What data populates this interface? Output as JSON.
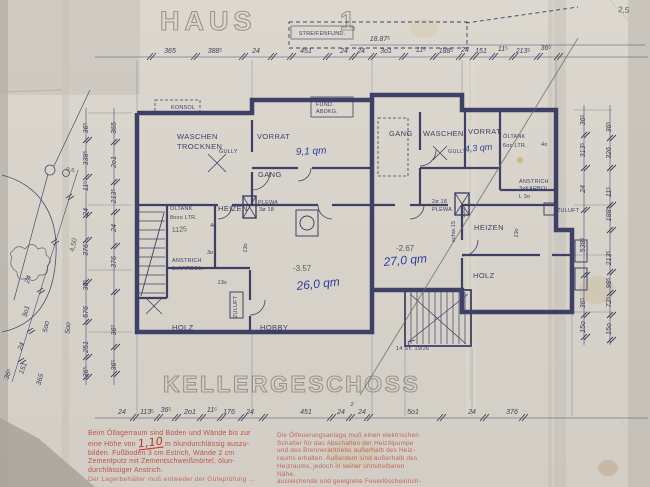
{
  "titles": {
    "haus": "HAUS",
    "house_no": "1",
    "floor": "KELLERGESCHOSS"
  },
  "annotations": {
    "streifenfund": "STREIFENFUND.",
    "overall": "18.87⁵",
    "corner": "2,5",
    "konsol": "KONSOL",
    "fund1": "FUND.",
    "fund2": "ABDKG.",
    "tree_h": "0,6",
    "pencil_len": "4,50",
    "pencil_tank": "1125",
    "stairs": "14 ST. 19/26",
    "schw": "schw.15"
  },
  "rooms": {
    "waschen1": "WASCHEN",
    "waschen2": "TROCKNEN",
    "vorrat_l": "VORRAT",
    "area_vorrat_l": "9,1 qm",
    "gang_l": "GANG",
    "gully_l": "GULLY",
    "oeltank_l1": "ÖLTANK",
    "oeltank_l2": "8ooo LTR.",
    "heizen_l": "HEIZEN",
    "plewa_l1": "PLEWA",
    "plewa_l2": "3ø 18",
    "anstrich1": "ANSTRICH",
    "anstrich2": "3xKARBOL.",
    "holz_l": "HOLZ",
    "hobby": "HOBBY",
    "zuluft": "ZULUFT",
    "level_l": "-3.57",
    "area_hobby": "26,0 qm",
    "gang_r": "GANG",
    "waschen_r": "WASCHEN",
    "vorrat_r": "VORRAT",
    "area_vorrat_r": "4,3 qm",
    "gully_r": "GULLY",
    "oeltank_r1": "ÖLTANK",
    "oeltank_r2": "6oo LTR.",
    "oeltank_r3": "4o",
    "anstrich_r3": "L 3o",
    "heizen_r": "HEIZEN",
    "holz_r": "HOLZ",
    "plewa_r1": "2ø 18",
    "plewa_r2": "PLEWA",
    "level_r": "-2.67",
    "area_r": "27,0 qm"
  },
  "dims": {
    "top": [
      "365",
      "388⁵",
      "24",
      "451",
      "24",
      "24",
      "3o1",
      "11⁵",
      "188⁵",
      "24",
      "151",
      "11⁵",
      "213⁵",
      "36⁵"
    ],
    "bottom": [
      "24",
      "113⁵",
      "36⁵",
      "2o1",
      "11⁵",
      "176",
      "24",
      "451",
      "24",
      "2",
      "24",
      "5o1",
      "24",
      "376"
    ],
    "left_outer": [
      "36⁵",
      "338⁵",
      "11⁵",
      "24",
      "376",
      "36⁵",
      "576",
      "251",
      "36⁵"
    ],
    "left_inner": [
      "365",
      "2o1",
      "213⁵",
      "24",
      "376",
      "36⁵",
      "36⁵"
    ],
    "far_left": [
      "24",
      "3o1",
      "5oo",
      "5oo",
      "24",
      "151",
      "36⁵",
      "365"
    ],
    "right_inner": [
      "36⁵",
      "313⁵",
      "24",
      "538⁵",
      "36⁵",
      "15o"
    ],
    "right_outer": [
      "36⁵",
      "326",
      "11⁵",
      "188⁵",
      "213⁵",
      "98⁵",
      "72⁵",
      "15o"
    ],
    "small": [
      "13o",
      "13o",
      "13o",
      "13o",
      "4o",
      "3o"
    ]
  },
  "notes": {
    "left": [
      "Beim Öllagerraum sind Boden und Wände bis zur",
      "eine Höhe von",
      "m ölundurchlässig auszu-",
      "bilden. Fußboden 3 cm Estrich, Wände 2 cm",
      "Zementputz mit Zementschweißmörtel, ölun-",
      "durchlässiger Anstrich."
    ],
    "left_hand": "1,10",
    "left_footer": "Der Lagerbehälter muß entweder der Güteprüfung …",
    "right": [
      "Die Ölfeuerungsanlage muß einen elektrischen",
      "Schalter für das Abschalten der Heizölpumpe",
      "und des Brennerantriebs außerhalb des Heiz-",
      "raums erhalten. Außerdem sind außerhalb des",
      "Heizraums, jedoch in seiner unmittelbaren Nähe,",
      "ausreichende und geeignete Feuerlöscheinrich-",
      "tungen und bereitzuhalten."
    ]
  },
  "colors": {
    "ink": "#3e4165",
    "blue": "#2c3e9b",
    "red_print": "#bf5148",
    "red_hand": "#c22f22",
    "paper": "#d7d3ca"
  }
}
